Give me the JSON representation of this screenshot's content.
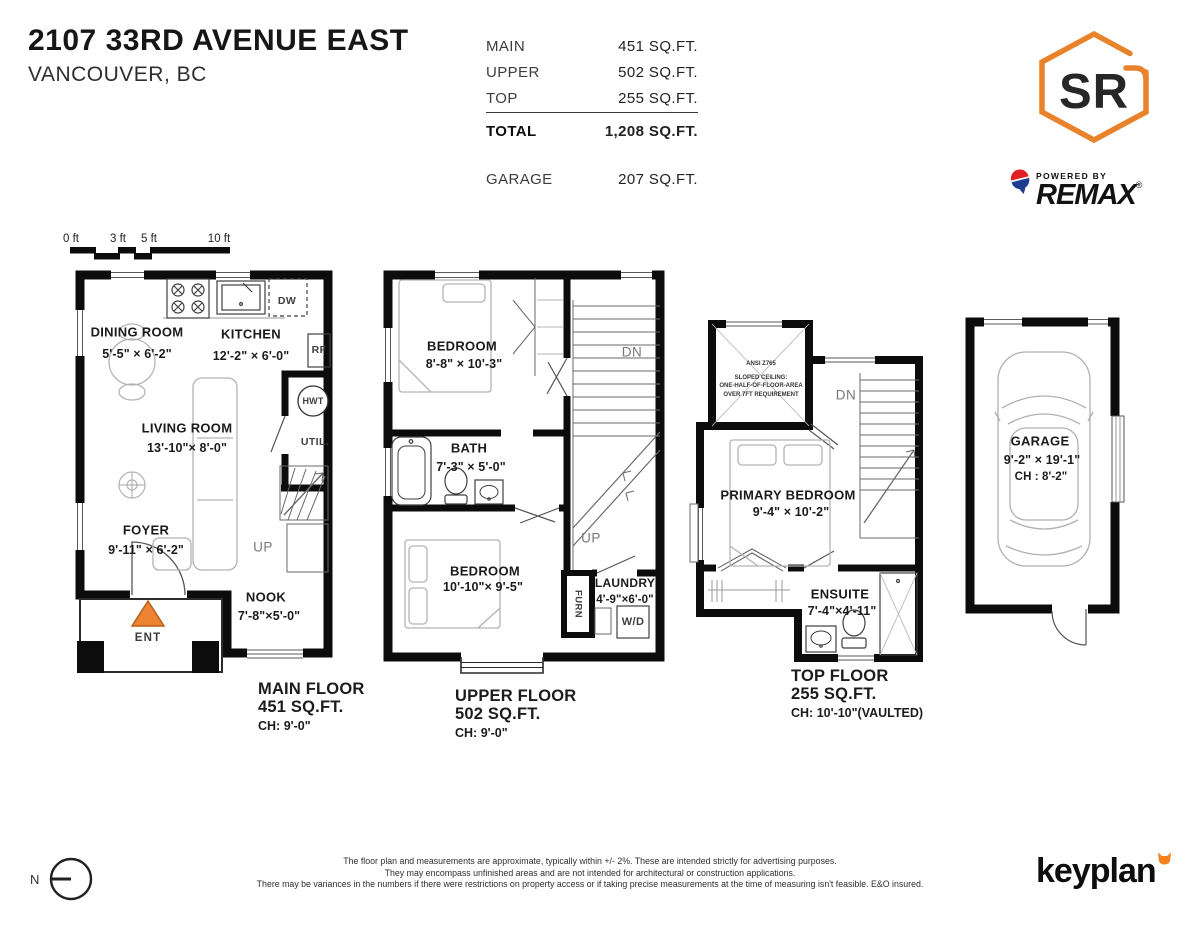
{
  "header": {
    "address_line1": "2107 33RD AVENUE EAST",
    "address_line2": "VANCOUVER, BC",
    "area_table": {
      "rows": [
        {
          "label": "MAIN",
          "value": "451 SQ.FT."
        },
        {
          "label": "UPPER",
          "value": "502 SQ.FT."
        },
        {
          "label": "TOP",
          "value": "255 SQ.FT."
        }
      ],
      "total_label": "TOTAL",
      "total_value": "1,208 SQ.FT.",
      "garage_label": "GARAGE",
      "garage_value": "207 SQ.FT."
    },
    "brand": {
      "monogram": "SR",
      "powered_by": "POWERED BY",
      "brand_name": "REMAX",
      "registered_mark": "®",
      "accent_color": "#E8832C",
      "remax_red": "#E01F26",
      "remax_blue": "#1D3C8F"
    }
  },
  "scale_bar": {
    "labels": [
      "0 ft",
      "3 ft",
      "5 ft",
      "10 ft"
    ]
  },
  "floors": {
    "main": {
      "caption": {
        "title": "MAIN FLOOR",
        "area": "451 SQ.FT.",
        "ceiling": "CH: 9'-0\""
      },
      "rooms": {
        "dining": {
          "name": "DINING ROOM",
          "dims": "5'-5\" × 6'-2\""
        },
        "kitchen": {
          "name": "KITCHEN",
          "dims": "12'-2\" × 6'-0\""
        },
        "living": {
          "name": "LIVING ROOM",
          "dims": "13'-10\"× 8'-0\""
        },
        "foyer": {
          "name": "FOYER",
          "dims": "9'-11\" × 6'-2\""
        },
        "nook": {
          "name": "NOOK",
          "dims": "7'-8\"×5'-0\""
        }
      },
      "tags": {
        "util": "UTIL.",
        "hwt": "HWT",
        "rf": "RF",
        "dw": "DW",
        "up": "UP",
        "ent": "ENT"
      }
    },
    "upper": {
      "caption": {
        "title": "UPPER FLOOR",
        "area": "502 SQ.FT.",
        "ceiling": "CH: 9'-0\""
      },
      "rooms": {
        "bedroom1": {
          "name": "BEDROOM",
          "dims": "8'-8\" × 10'-3\""
        },
        "bath": {
          "name": "BATH",
          "dims": "7'-3\" × 5'-0\""
        },
        "bedroom2": {
          "name": "BEDROOM",
          "dims": "10'-10\"×  9'-5\""
        },
        "laundry": {
          "name": "LAUNDRY",
          "dims": "4'-9\"×6'-0\""
        }
      },
      "tags": {
        "dn": "DN",
        "up": "UP",
        "furn": "FURN",
        "wd": "W/D"
      }
    },
    "top": {
      "caption": {
        "title": "TOP FLOOR",
        "area": "255 SQ.FT.",
        "ceiling": "CH: 10'-10\"(VAULTED)"
      },
      "rooms": {
        "primary": {
          "name": "PRIMARY BEDROOM",
          "dims": "9'-4\" × 10'-2\""
        },
        "ensuite": {
          "name": "ENSUITE",
          "dims": "7'-4\"×4'-11\""
        }
      },
      "tags": {
        "dn": "DN"
      },
      "sloped_note": {
        "line1": "ANSI Z765",
        "line2": "SLOPED CEILING:",
        "line3": "ONE-HALF-OF-FLOOR-AREA",
        "line4": "OVER 7FT REQUIREMENT"
      }
    },
    "garage": {
      "name": "GARAGE",
      "dims": "9'-2\" × 19'-1\"",
      "ceiling": "CH : 8'-2\""
    }
  },
  "footer": {
    "north_label": "N",
    "disclaimer": [
      "The floor plan and measurements are approximate, typically within +/- 2%. These are intended strictly for advertising purposes.",
      "They may encompass unfinished areas and are not intended for architectural or construction applications.",
      "There may be variances in the numbers if there were restrictions on property access or if taking precise measurements at the time of measuring isn't feasible. E&O insured."
    ],
    "keyplan_brand": "keyplan"
  }
}
